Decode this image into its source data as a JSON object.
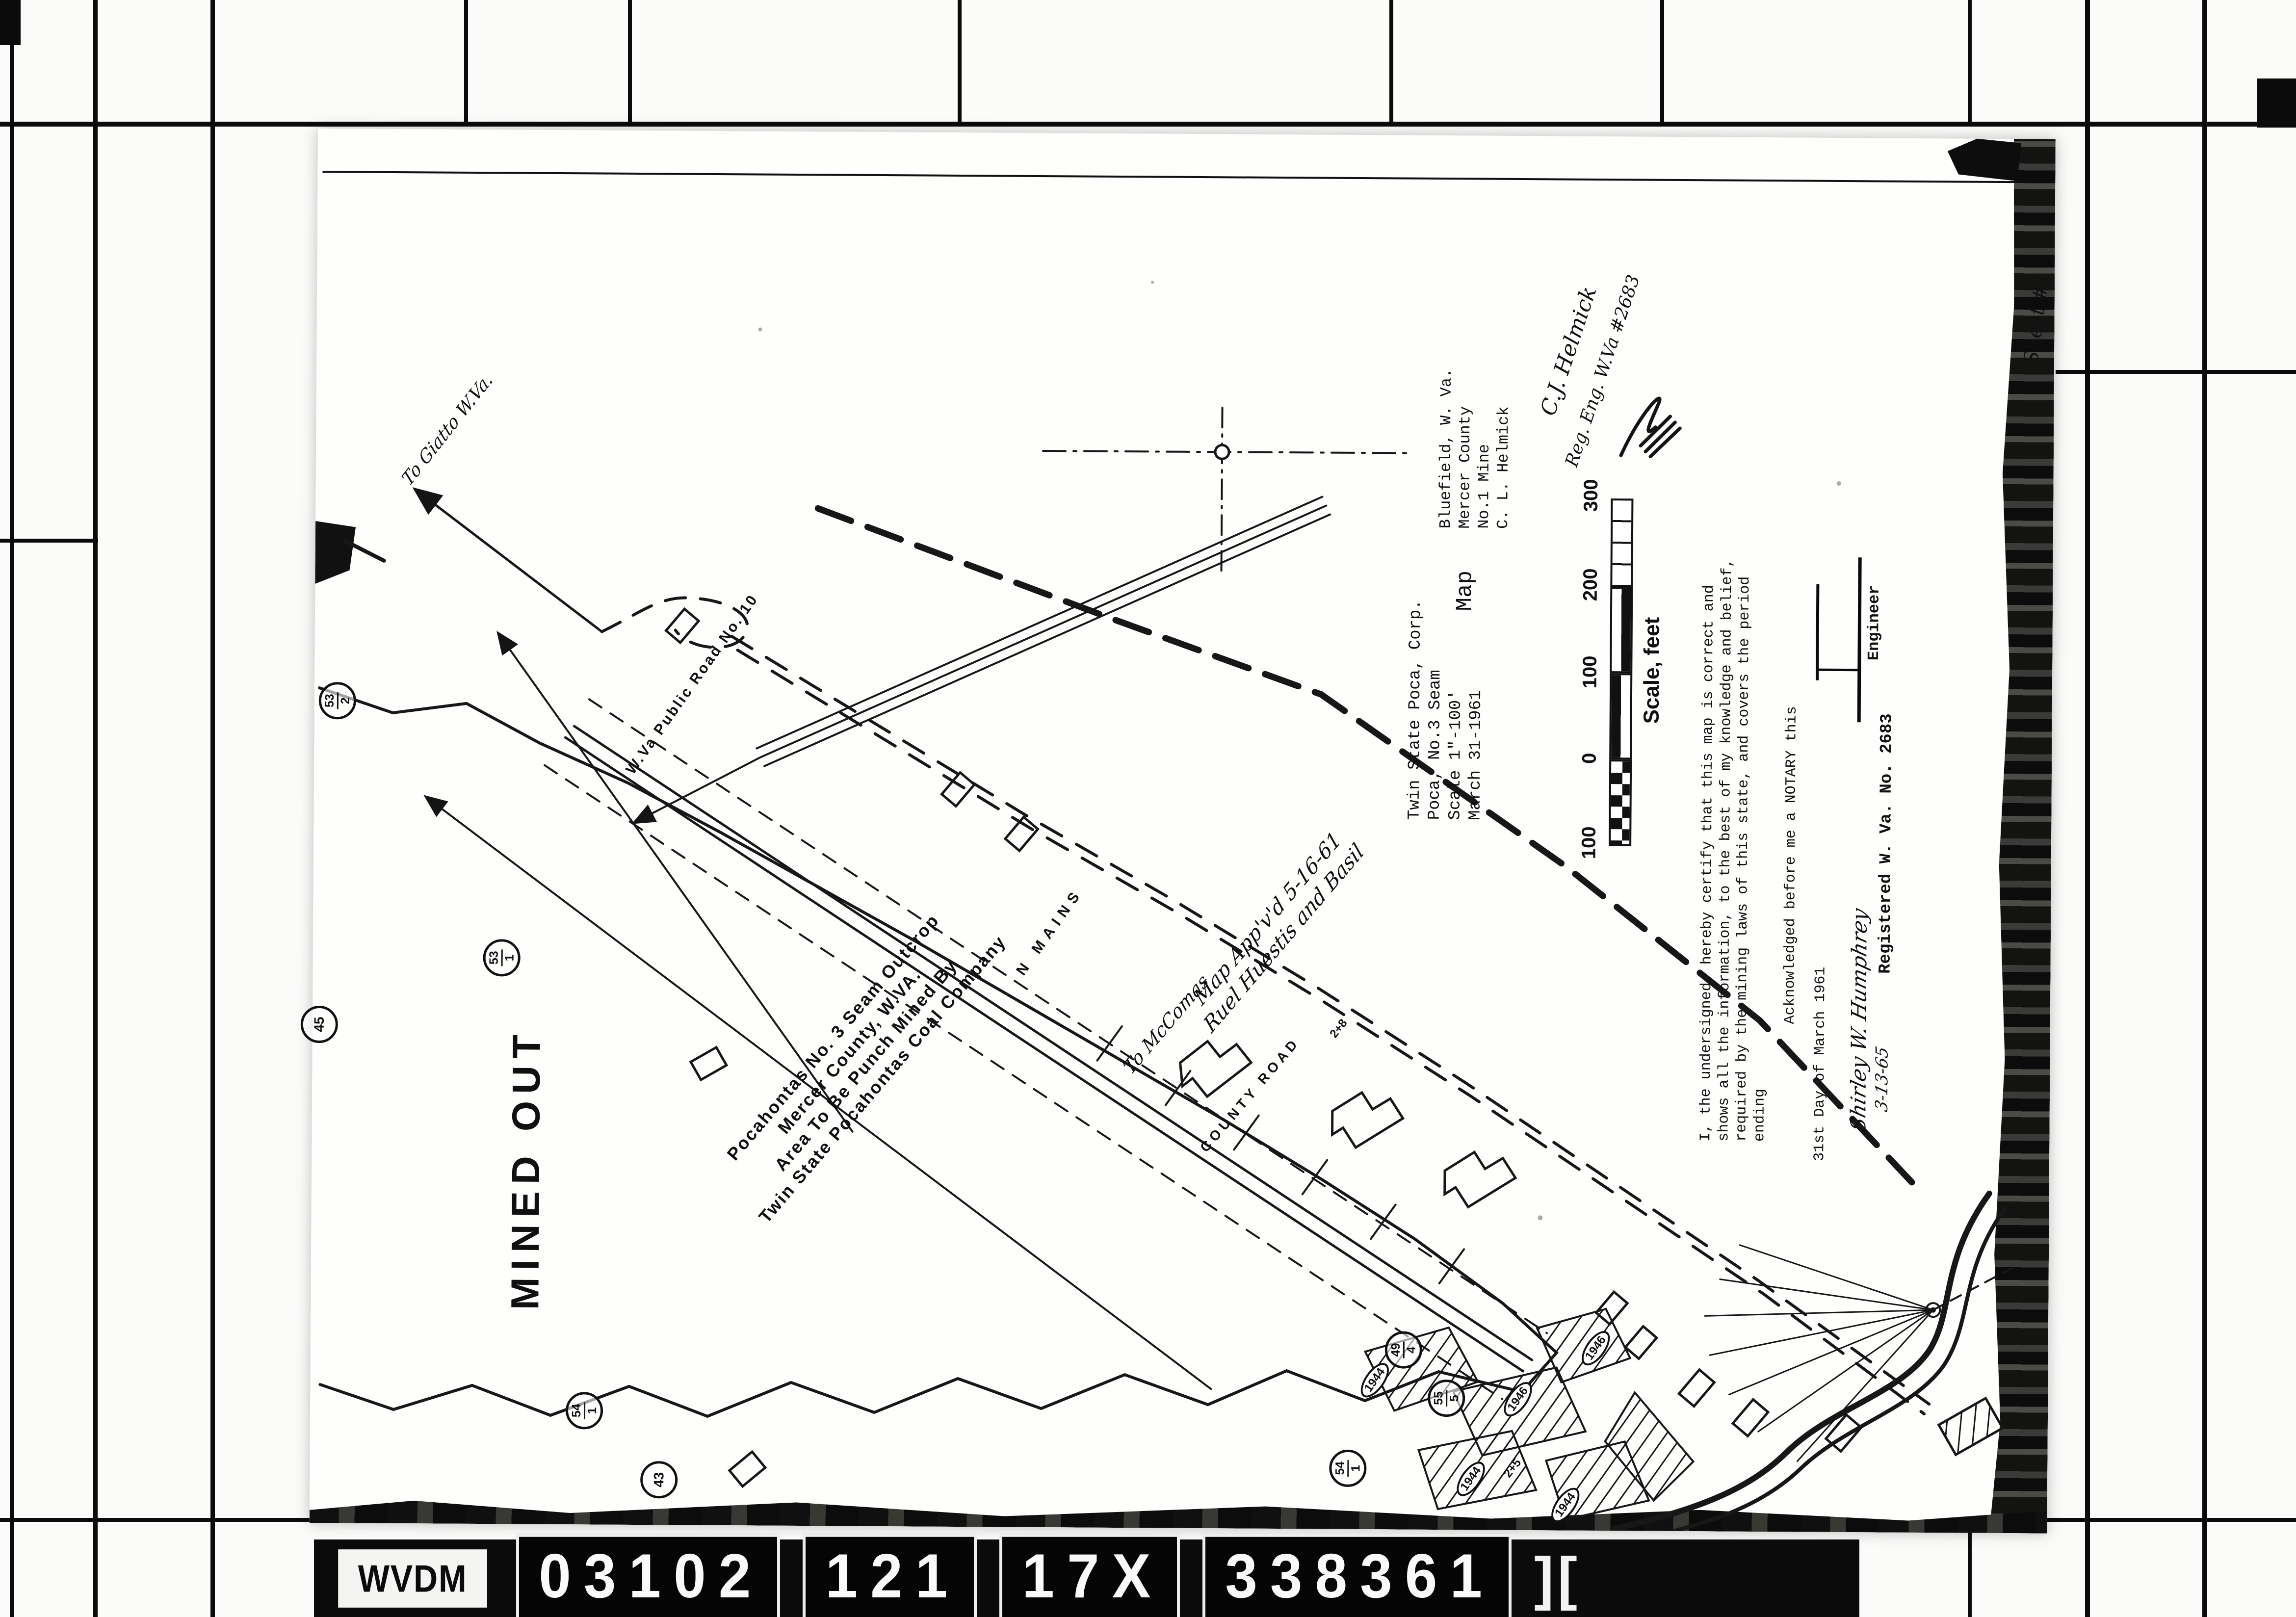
{
  "frame": {
    "plate": "WVDM",
    "codes": [
      "03102",
      "121",
      "17X",
      "338361"
    ],
    "end_mark": "]["
  },
  "sheet": {
    "sheet_no": "Sheet #1",
    "title": {
      "heading": "Map",
      "company": [
        "Twin State Poca, Corp.",
        "Poca, No.3 Seam",
        "Scale 1\"-100'",
        "March 31-1961"
      ],
      "location": [
        "Bluefield, W. Va.",
        "Mercer County",
        "No.1 Mine",
        "C. L. Helmick"
      ]
    },
    "scale_bar": {
      "ticks": [
        "300",
        "200",
        "100",
        "0",
        "100"
      ],
      "caption": "Scale, feet"
    },
    "certification": {
      "lines": [
        "I, the undersigned, hereby certify that this map is correct and",
        "shows all the information, to the best of my knowledge and belief,",
        "required by the mining laws of this state, and covers the period",
        "ending"
      ],
      "ack_line": "Acknowledged before me a NOTARY this",
      "ack_date": "31st Day of March 1961",
      "notary_signature": "Shirley W. Humphrey",
      "notary_date": "3-13-65",
      "engineer_label": "Engineer",
      "registration": "Registered W. Va. No. 2683"
    },
    "engineer_note": {
      "line1": "C.J. Helmick",
      "line2": "Reg. Eng. W.Va #2683"
    },
    "notes": {
      "mined_out": "MINED OUT",
      "outcrop": [
        "Pocahontas No. 3 Seam Outcrop",
        "Mercer County, W.VA.",
        "Area To Be Punch Mined By",
        "Twin State Pocahontas Coal Company"
      ],
      "approval": [
        "Map App'v'd 5-16-61",
        "Ruel Huestis and Basil"
      ],
      "to_giatto": "To Giatto W.Va.",
      "to_mccomas": "To McComas",
      "public_road": "W.Va Public Road No. 10",
      "county_road": "COUNTY ROAD",
      "mains": "N MAINS"
    },
    "stations": [
      {
        "n": "53",
        "d": "2"
      },
      {
        "n": "53",
        "d": "1"
      },
      {
        "n": "45",
        "d": ""
      },
      {
        "n": "54",
        "d": "1"
      },
      {
        "n": "43",
        "d": ""
      },
      {
        "n": "49",
        "d": "4"
      },
      {
        "n": "55",
        "d": "5"
      },
      {
        "n": "54",
        "d": "1"
      }
    ],
    "years": [
      "1944",
      "1946",
      "1944",
      "1944",
      "1946"
    ],
    "survey": [
      "2+8",
      "2+5"
    ]
  }
}
